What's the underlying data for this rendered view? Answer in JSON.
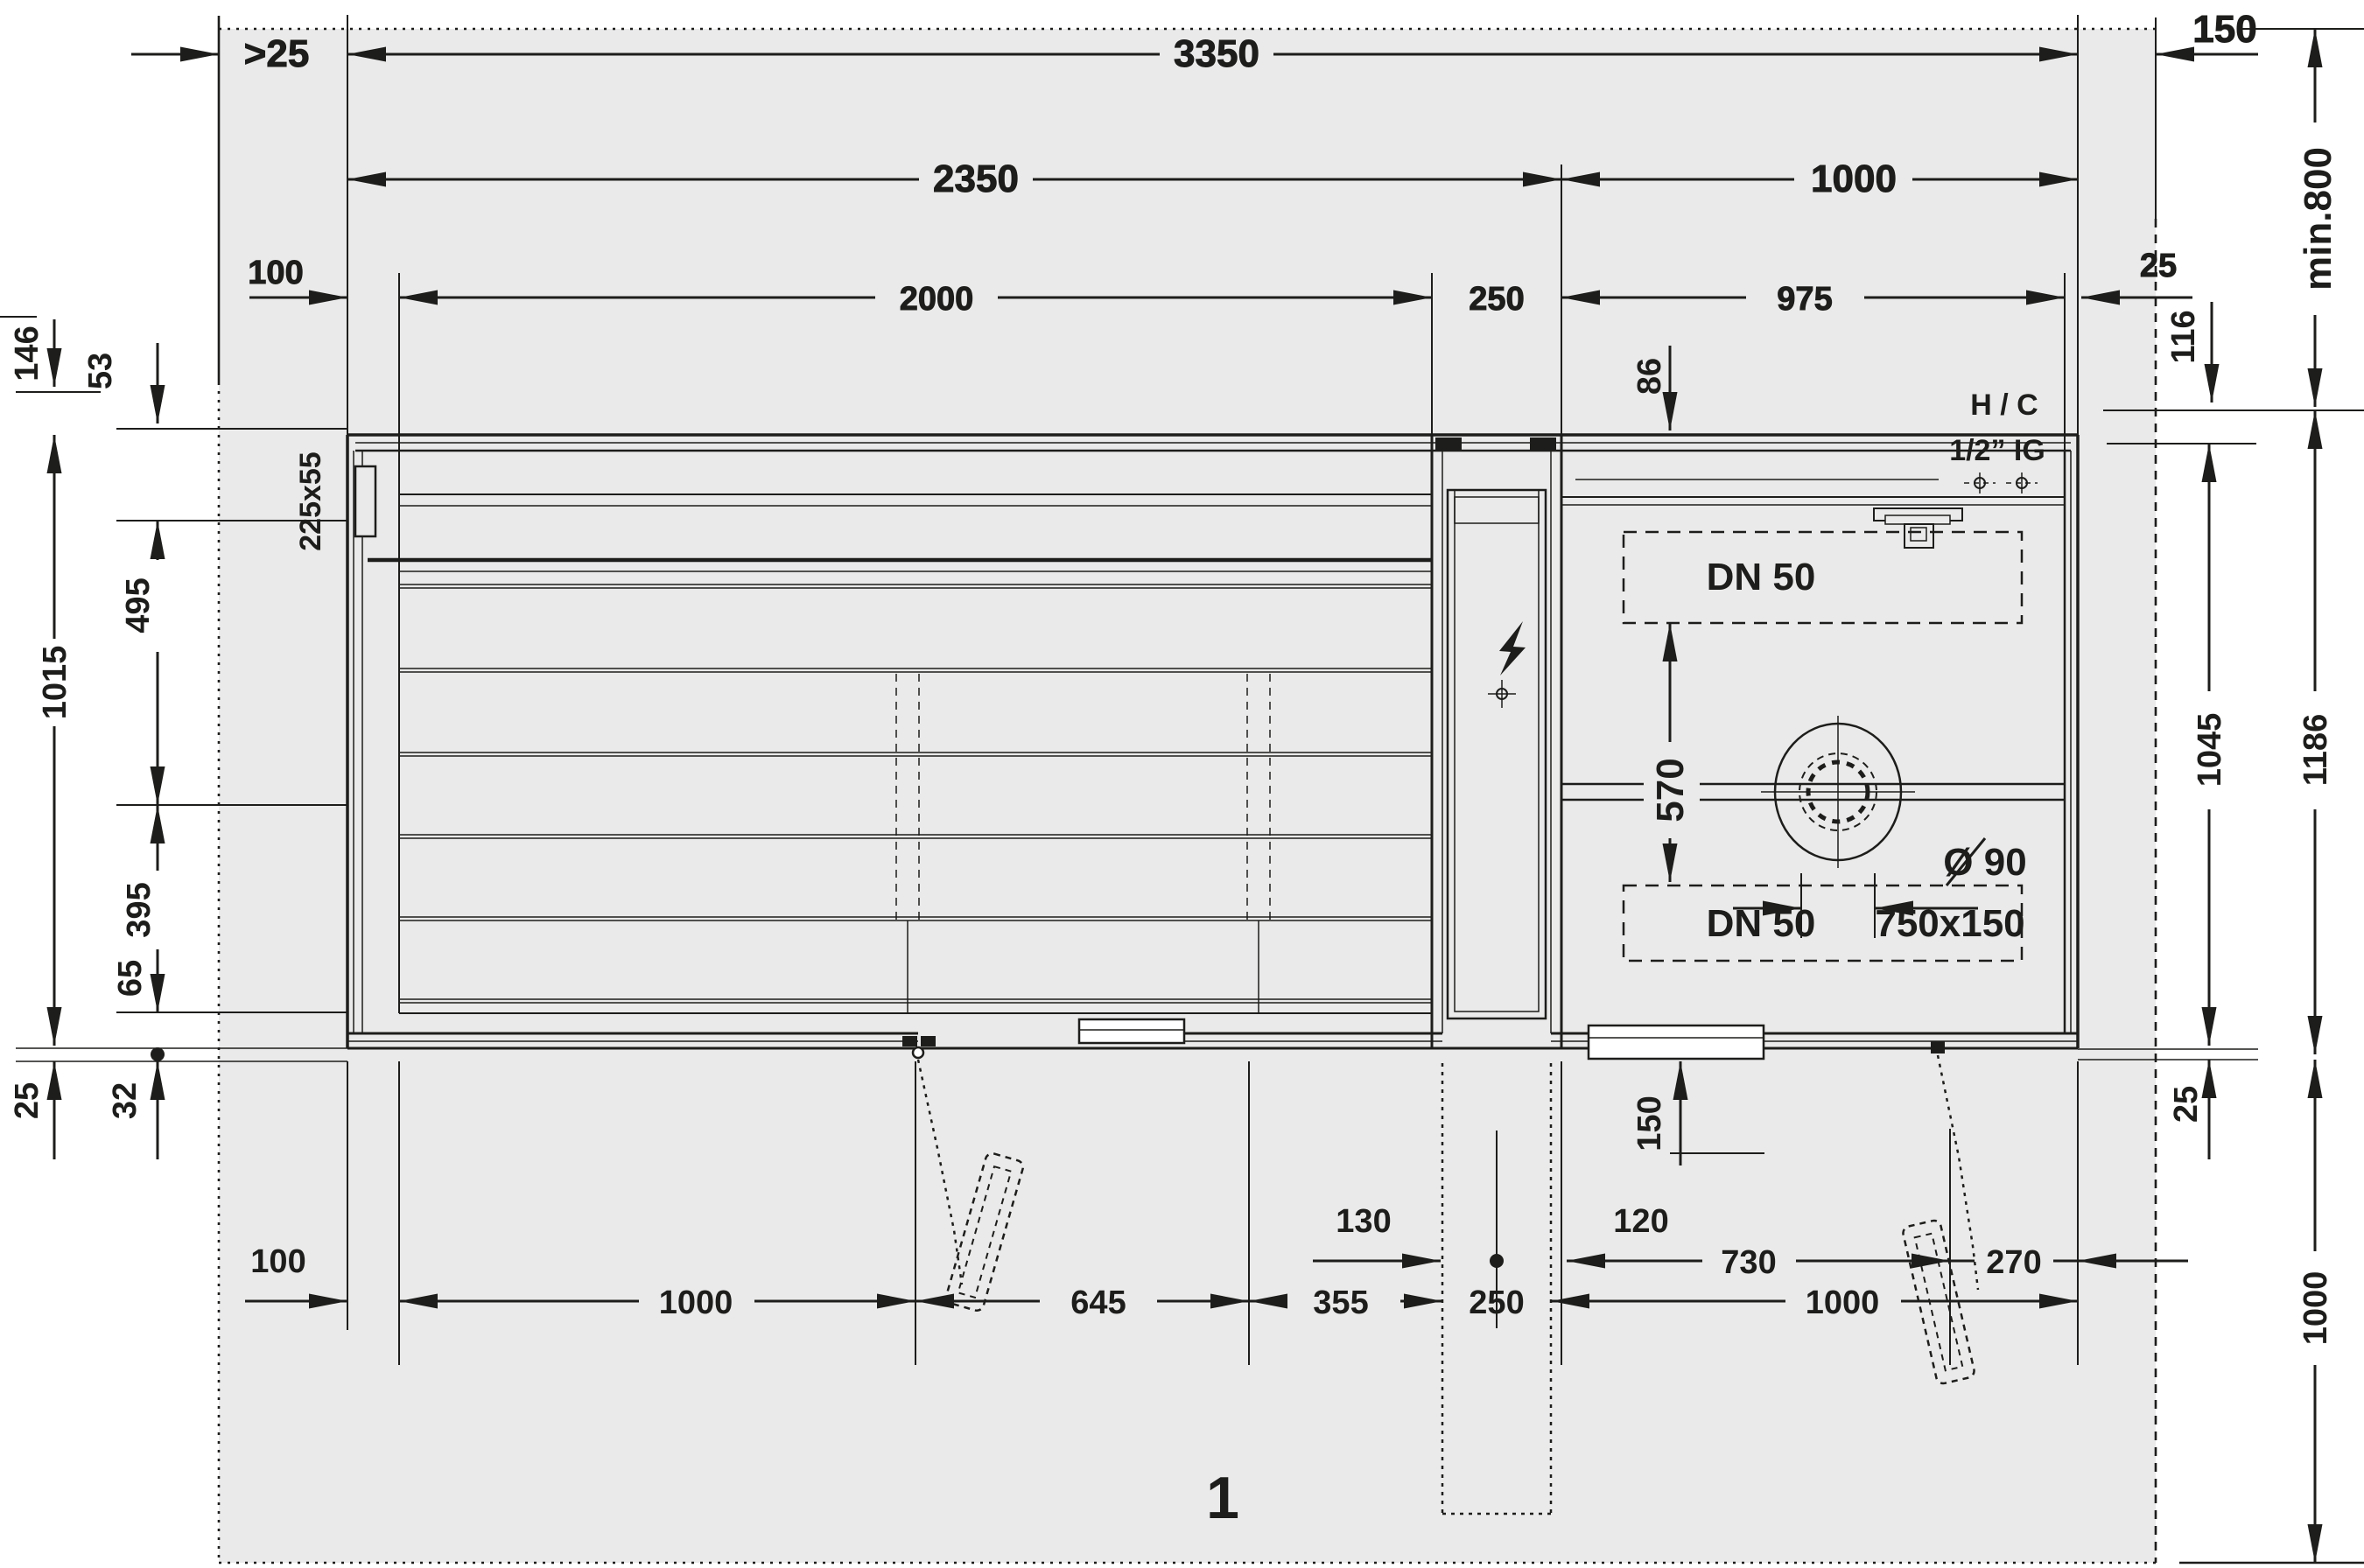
{
  "colors": {
    "line": "#1d1d1b",
    "floor_area": "#eaeaea",
    "paper": "#ffffff"
  },
  "figure": {
    "number": "1"
  },
  "top_dims": {
    "row1_clearance_left": ">25",
    "row1_total_width": "3350",
    "row1_clearance_right": "150",
    "row2_sauna_width": "2350",
    "row2_shower_width": "1000",
    "row3_wall_offset": "100",
    "row3_bench_length": "2000",
    "row3_door_width": "250",
    "row3_shower_inner_width": "975",
    "row3_wall_thickness": "25"
  },
  "left_dims": {
    "offset_146": "146",
    "offset_53": "53",
    "bench_depth_495": "495",
    "interior_depth_1015": "1015",
    "offset_395": "395",
    "offset_65": "65",
    "lip_25": "25",
    "lip_32": "32",
    "panel_size": "225x55"
  },
  "right_dims": {
    "min_depth": "min.800",
    "offset_116": "116",
    "depth_1045": "1045",
    "depth_1186": "1186",
    "lip_25": "25",
    "rear_clearance_1000": "1000"
  },
  "bottom_dims": {
    "track_offset_150": "150",
    "offset_130": "130",
    "offset_120": "120",
    "hinge_offset_730": "730",
    "edge_offset_270": "270",
    "wall_offset_100": "100",
    "bay_1000": "1000",
    "bay_645": "645",
    "bay_355": "355",
    "door_250": "250",
    "shower_1000": "1000"
  },
  "shower_annotations": {
    "supply_line1": "H / C",
    "supply_line2": "1/2” IG",
    "drain_top": "DN 50",
    "drain_bottom": "DN 50",
    "drain_bottom_size": "750x150",
    "drain_diameter": "Ø 90",
    "drain_spacing_570": "570",
    "channel_offset_86": "86"
  }
}
